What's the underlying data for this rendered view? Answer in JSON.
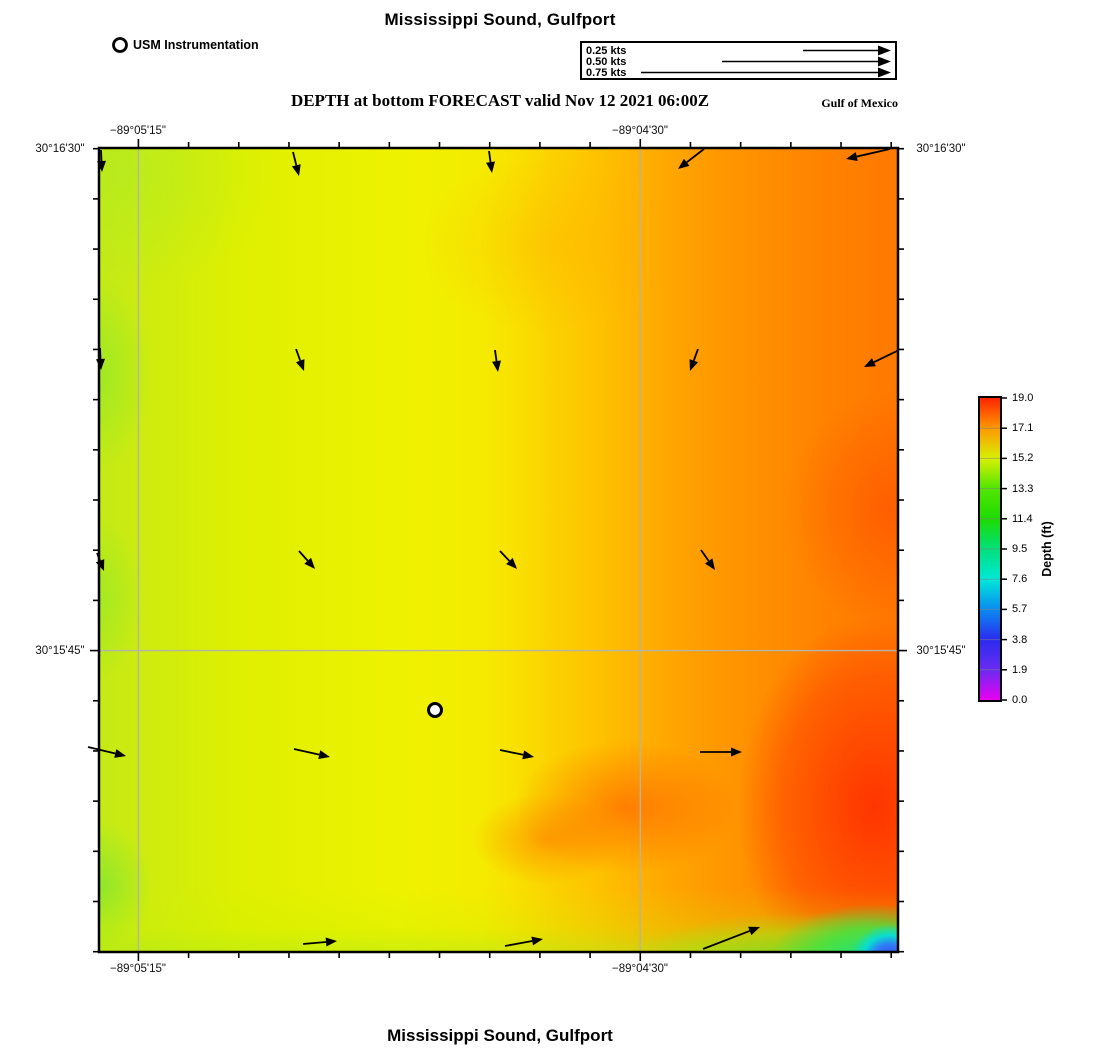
{
  "titles": {
    "top": "Mississippi Sound, Gulfport",
    "bottom": "Mississippi Sound, Gulfport",
    "forecast": "DEPTH at bottom FORECAST valid Nov 12 2021 06:00Z",
    "region": "Gulf of Mexico"
  },
  "instrument_legend": {
    "label": "USM Instrumentation",
    "marker": {
      "x": 120,
      "y": 45
    }
  },
  "velocity_legend": {
    "tip_x": 891,
    "rows": [
      {
        "label": "0.25 kts",
        "tail_x": 803,
        "y": 50.5
      },
      {
        "label": "0.50 kts",
        "tail_x": 722,
        "y": 61.5
      },
      {
        "label": "0.75 kts",
        "tail_x": 641,
        "y": 72.5
      }
    ]
  },
  "map": {
    "px": {
      "left": 99,
      "top": 148,
      "right": 898,
      "bottom": 952
    },
    "grid": {
      "vx": [
        138.4,
        640.3
      ],
      "hy": [
        650.6
      ]
    },
    "tick_step": 50.1875,
    "axis": {
      "top": [
        {
          "text": "−89°05'15\"",
          "x": 138
        },
        {
          "text": "−89°04'30\"",
          "x": 640
        }
      ],
      "bottom": [
        {
          "text": "−89°05'15\"",
          "x": 138
        },
        {
          "text": "−89°04'30\"",
          "x": 640
        }
      ],
      "left": [
        {
          "text": "30°16'30\"",
          "y": 148
        },
        {
          "text": "30°15'45\"",
          "y": 650
        }
      ],
      "right": [
        {
          "text": "30°16'30\"",
          "y": 148
        },
        {
          "text": "30°15'45\"",
          "y": 650
        }
      ]
    },
    "station": {
      "x": 435,
      "y": 710
    },
    "arrows": [
      [
        101,
        150,
        102,
        172
      ],
      [
        293,
        152,
        299,
        176
      ],
      [
        489,
        151,
        492,
        173
      ],
      [
        704,
        149,
        678,
        169
      ],
      [
        890,
        149,
        846,
        159
      ],
      [
        100,
        348,
        101,
        370
      ],
      [
        296,
        349,
        304,
        371
      ],
      [
        495,
        350,
        498,
        372
      ],
      [
        698,
        349,
        690,
        371
      ],
      [
        897,
        351,
        864,
        367
      ],
      [
        97,
        553,
        104,
        571
      ],
      [
        299,
        551,
        315,
        569
      ],
      [
        500,
        551,
        517,
        569
      ],
      [
        701,
        550,
        715,
        570
      ],
      [
        88,
        747,
        126,
        756
      ],
      [
        294,
        749,
        330,
        757
      ],
      [
        500,
        750,
        534,
        757
      ],
      [
        700,
        752,
        742,
        752
      ],
      [
        303,
        944,
        337,
        941
      ],
      [
        505,
        946,
        543,
        939
      ],
      [
        703,
        949,
        760,
        927
      ]
    ]
  },
  "colorbar": {
    "title": "Depth (ft)",
    "max": 19,
    "stops": [
      {
        "value": 0.0,
        "label": "0.0",
        "color": "#e800f0"
      },
      {
        "value": 1.9,
        "label": "1.9",
        "color": "#6a2bf2"
      },
      {
        "value": 3.8,
        "label": "3.8",
        "color": "#2b2bf0"
      },
      {
        "value": 5.7,
        "label": "5.7",
        "color": "#0a8cf0"
      },
      {
        "value": 7.6,
        "label": "7.6",
        "color": "#00e8d8"
      },
      {
        "value": 9.5,
        "label": "9.5",
        "color": "#00e07a"
      },
      {
        "value": 11.4,
        "label": "11.4",
        "color": "#1edc00"
      },
      {
        "value": 13.3,
        "label": "13.3",
        "color": "#52e600"
      },
      {
        "value": 15.2,
        "label": "15.2",
        "color": "#d8f000"
      },
      {
        "value": 17.1,
        "label": "17.1",
        "color": "#ff9800"
      },
      {
        "value": 19.0,
        "label": "19.0",
        "color": "#ff2400"
      }
    ]
  },
  "chart_data": {
    "type": "heatmap",
    "title": "Mississippi Sound, Gulfport",
    "subtitle": "DEPTH at bottom FORECAST valid Nov 12 2021 06:00Z",
    "region_label": "Gulf of Mexico",
    "x_axis": {
      "label": "longitude",
      "ticks": [
        "−89°05'15\"",
        "−89°04'30\""
      ]
    },
    "y_axis": {
      "label": "latitude",
      "ticks": [
        "30°16'30\"",
        "30°15'45\""
      ]
    },
    "colorbar": {
      "label": "Depth (ft)",
      "range": [
        0.0,
        19.0
      ],
      "ticks": [
        0.0,
        1.9,
        3.8,
        5.7,
        7.6,
        9.5,
        11.4,
        13.3,
        15.2,
        17.1,
        19.0
      ]
    },
    "field_summary": "Depth about 14-15 ft (yellow-green) along the western edge, 15-16 ft (yellow) mid-sound, deepening to 18-19 ft (orange-red) in the east; shallow 0-12 ft patch (green to blue) in the extreme southeast corner",
    "current_vectors": {
      "legend_kts": [
        0.25,
        0.5,
        0.75
      ],
      "description": "Current arrows point south along the northern rows, southeast in mid-map rows, east along the southern row, and northeast along the bottom edge; speeds roughly 0.05-0.15 kts"
    },
    "station_marker": "USM Instrumentation",
    "grid": "on"
  }
}
